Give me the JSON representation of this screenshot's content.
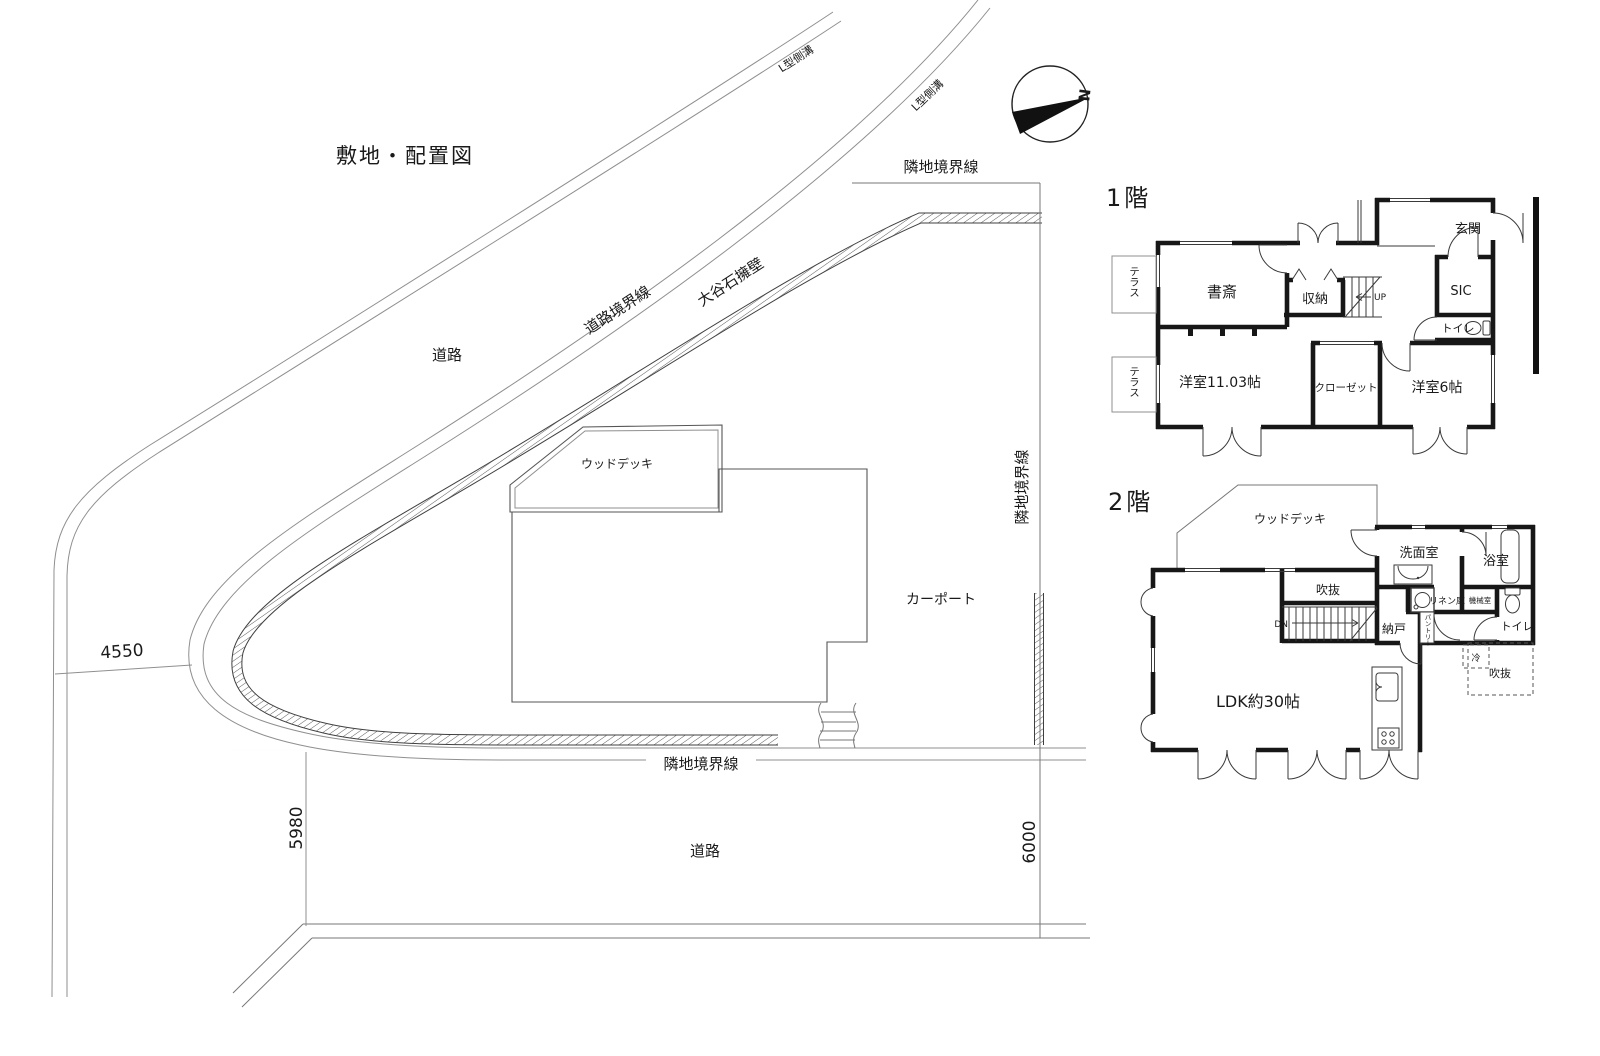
{
  "title": "敷地・配置図",
  "site": {
    "labels": {
      "gutter_far": "L型側溝",
      "gutter_near": "L型側溝",
      "road_upper": "道路",
      "road_lower": "道路",
      "road_boundary": "道路境界線",
      "retaining_wall": "大谷石擁壁",
      "boundary_top": "隣地境界線",
      "boundary_right": "隣地境界線",
      "boundary_bottom": "隣地境界線",
      "wood_deck": "ウッドデッキ",
      "carport": "カーポート",
      "north": "N"
    },
    "dimensions": {
      "bend_width": "4550",
      "road_width_west": "5980",
      "road_width_east": "6000"
    }
  },
  "floor1": {
    "heading": "1階",
    "rooms": {
      "study": "書斎",
      "storage": "収納",
      "entrance": "玄関",
      "sic": "SIC",
      "toilet": "トイレ",
      "up": "UP",
      "western_room_large": "洋室11.03帖",
      "closet": "クローゼット",
      "western_room_small": "洋室6帖",
      "terrace1": "テラス",
      "terrace2": "テラス"
    }
  },
  "floor2": {
    "heading": "2階",
    "rooms": {
      "wood_deck": "ウッドデッキ",
      "washroom": "洗面室",
      "bathroom": "浴室",
      "void_top": "吹抜",
      "void_bottom": "吹抜",
      "dn": "DN",
      "storeroom": "納戸",
      "linen": "リネン庫",
      "machine_room": "機械室",
      "pantry": "パントリー",
      "toilet": "トイレ",
      "fridge": "冷",
      "ldk": "LDK約30帖"
    }
  }
}
